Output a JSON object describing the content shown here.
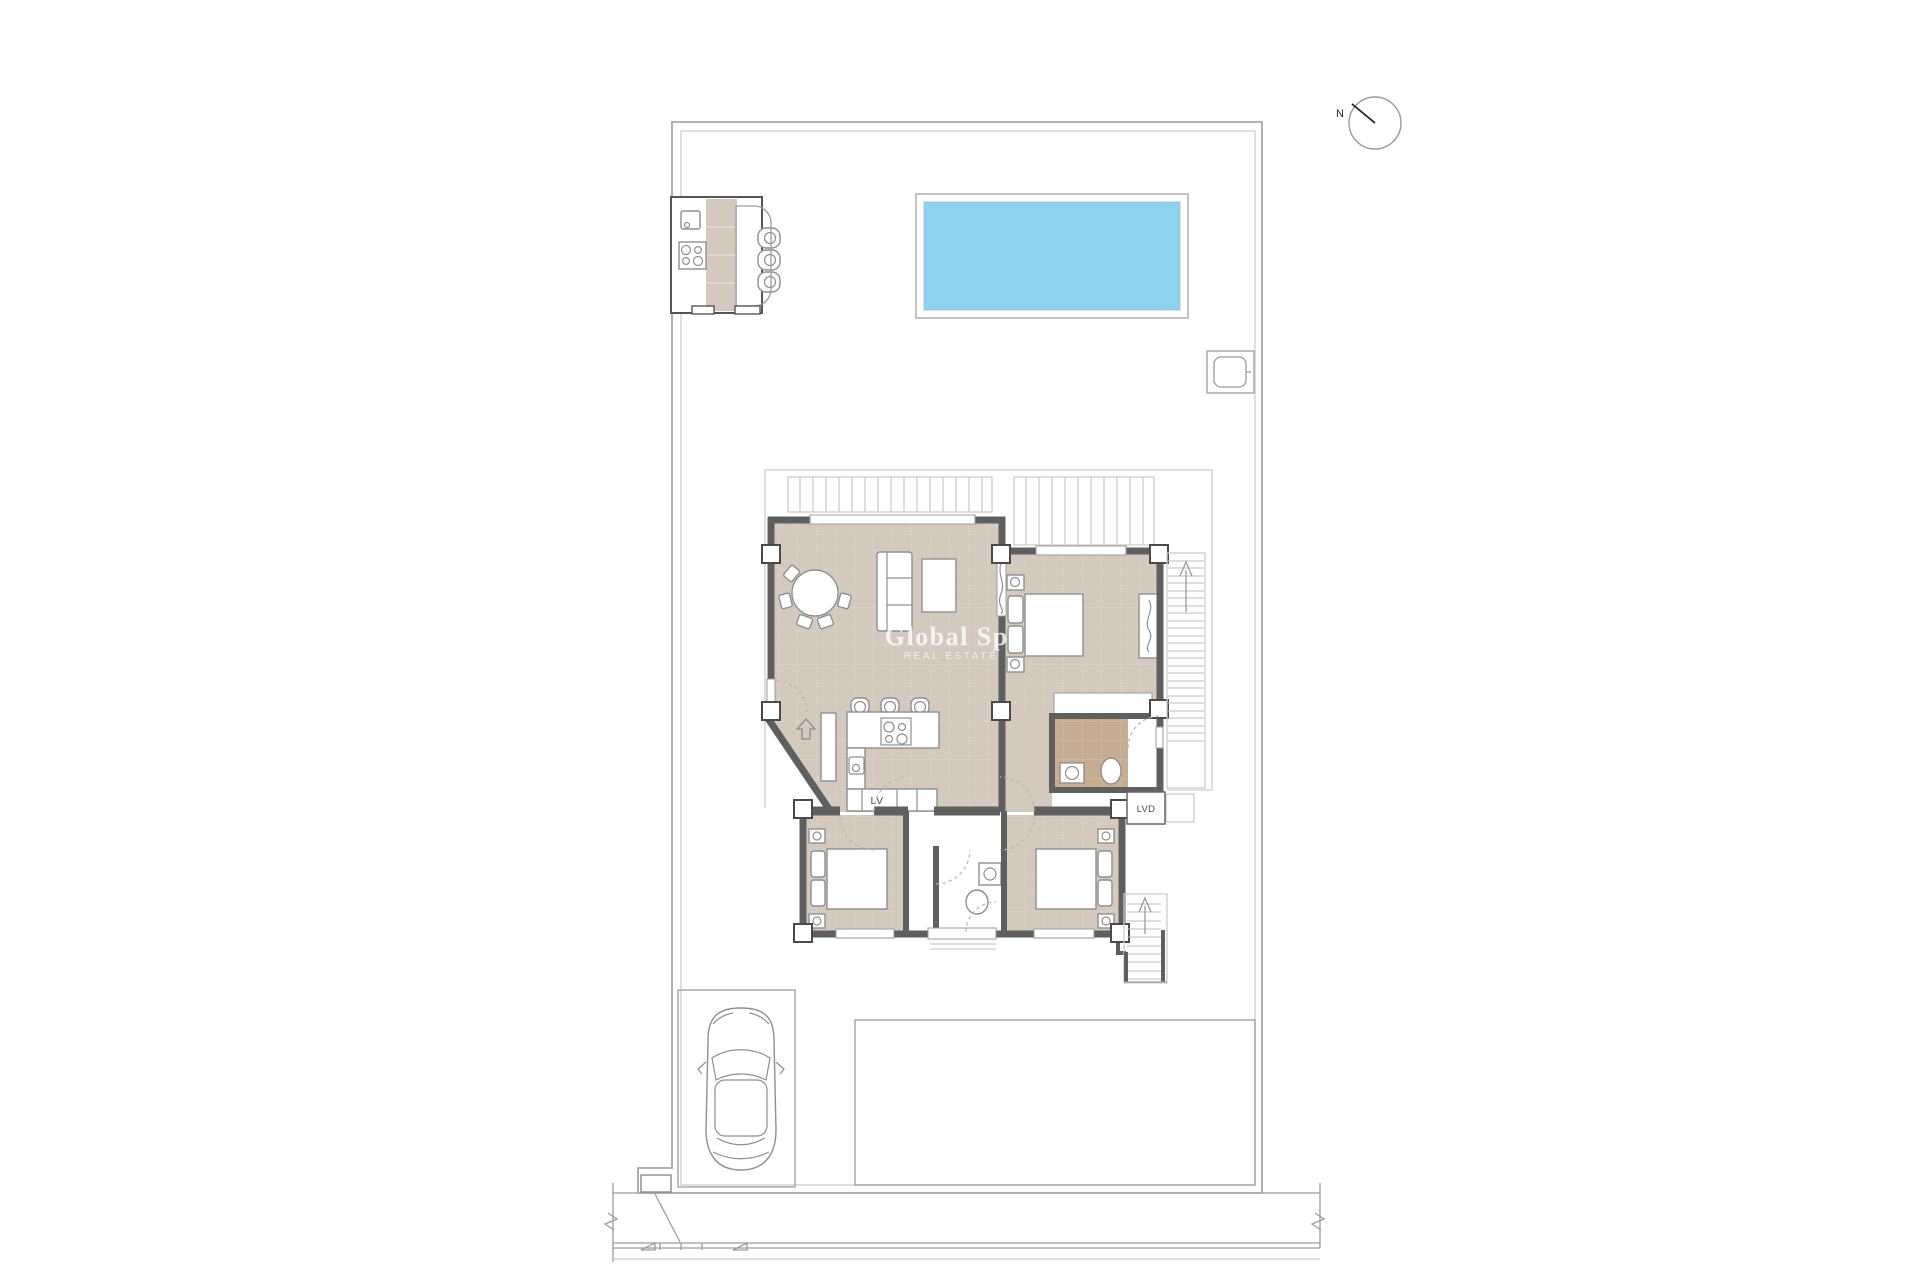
{
  "watermark": {
    "title": "Global Spa",
    "subtitle": "REAL ESTATE"
  },
  "labels": {
    "north": "N",
    "dishwasher": "LV",
    "laundry": "LVD"
  },
  "colors": {
    "background": "#ffffff",
    "floor": "#d4c9bd",
    "bath_floor": "#c6ad92",
    "pool": "#8fd2ee",
    "wall": "#5f5f5f",
    "outline": "#9c9c9c",
    "light": "#cdcdcd",
    "furniture": "#8f8f8f",
    "watermark": "#ffffff"
  }
}
